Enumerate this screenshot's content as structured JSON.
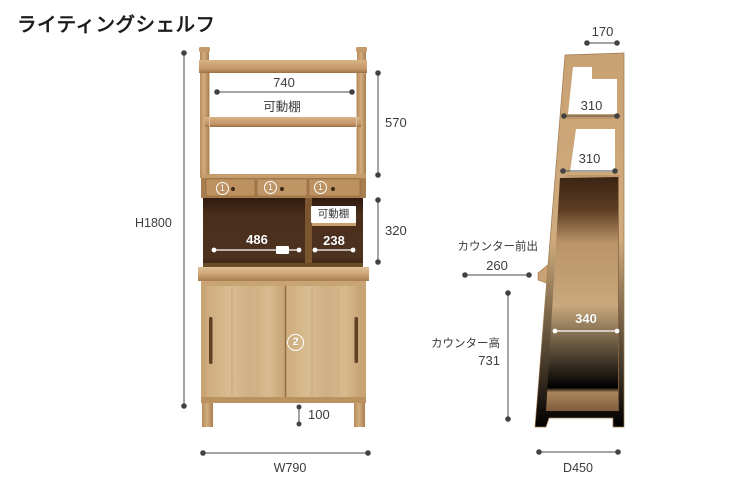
{
  "title": "ライティングシェルフ",
  "front": {
    "overall_height": "H1800",
    "overall_width": "W790",
    "shelf_width": "740",
    "movable_shelf_top_label": "可動棚",
    "upper_section_height": "570",
    "niche_height": "320",
    "niche_left_width": "486",
    "niche_right_width": "238",
    "movable_shelf_right_label": "可動棚",
    "leg_height": "100",
    "markers": {
      "drawer": "1",
      "cabinet": "2"
    }
  },
  "side": {
    "top_depth": "170",
    "shelf_depth_upper": "310",
    "shelf_depth_lower": "310",
    "counter_overhang_label": "カウンター前出",
    "counter_overhang": "260",
    "counter_height_label": "カウンター高",
    "counter_height": "731",
    "counter_inner_depth": "340",
    "overall_depth": "D450"
  },
  "colors": {
    "wood_light": "#d3b588",
    "wood_mid": "#c49a6c",
    "wood_dark_edge": "#9a7347",
    "interior_dark": "#412817",
    "dimension_line": "#4a4a4a",
    "annotation_white": "#ffffff",
    "text": "#3c3c3c"
  }
}
